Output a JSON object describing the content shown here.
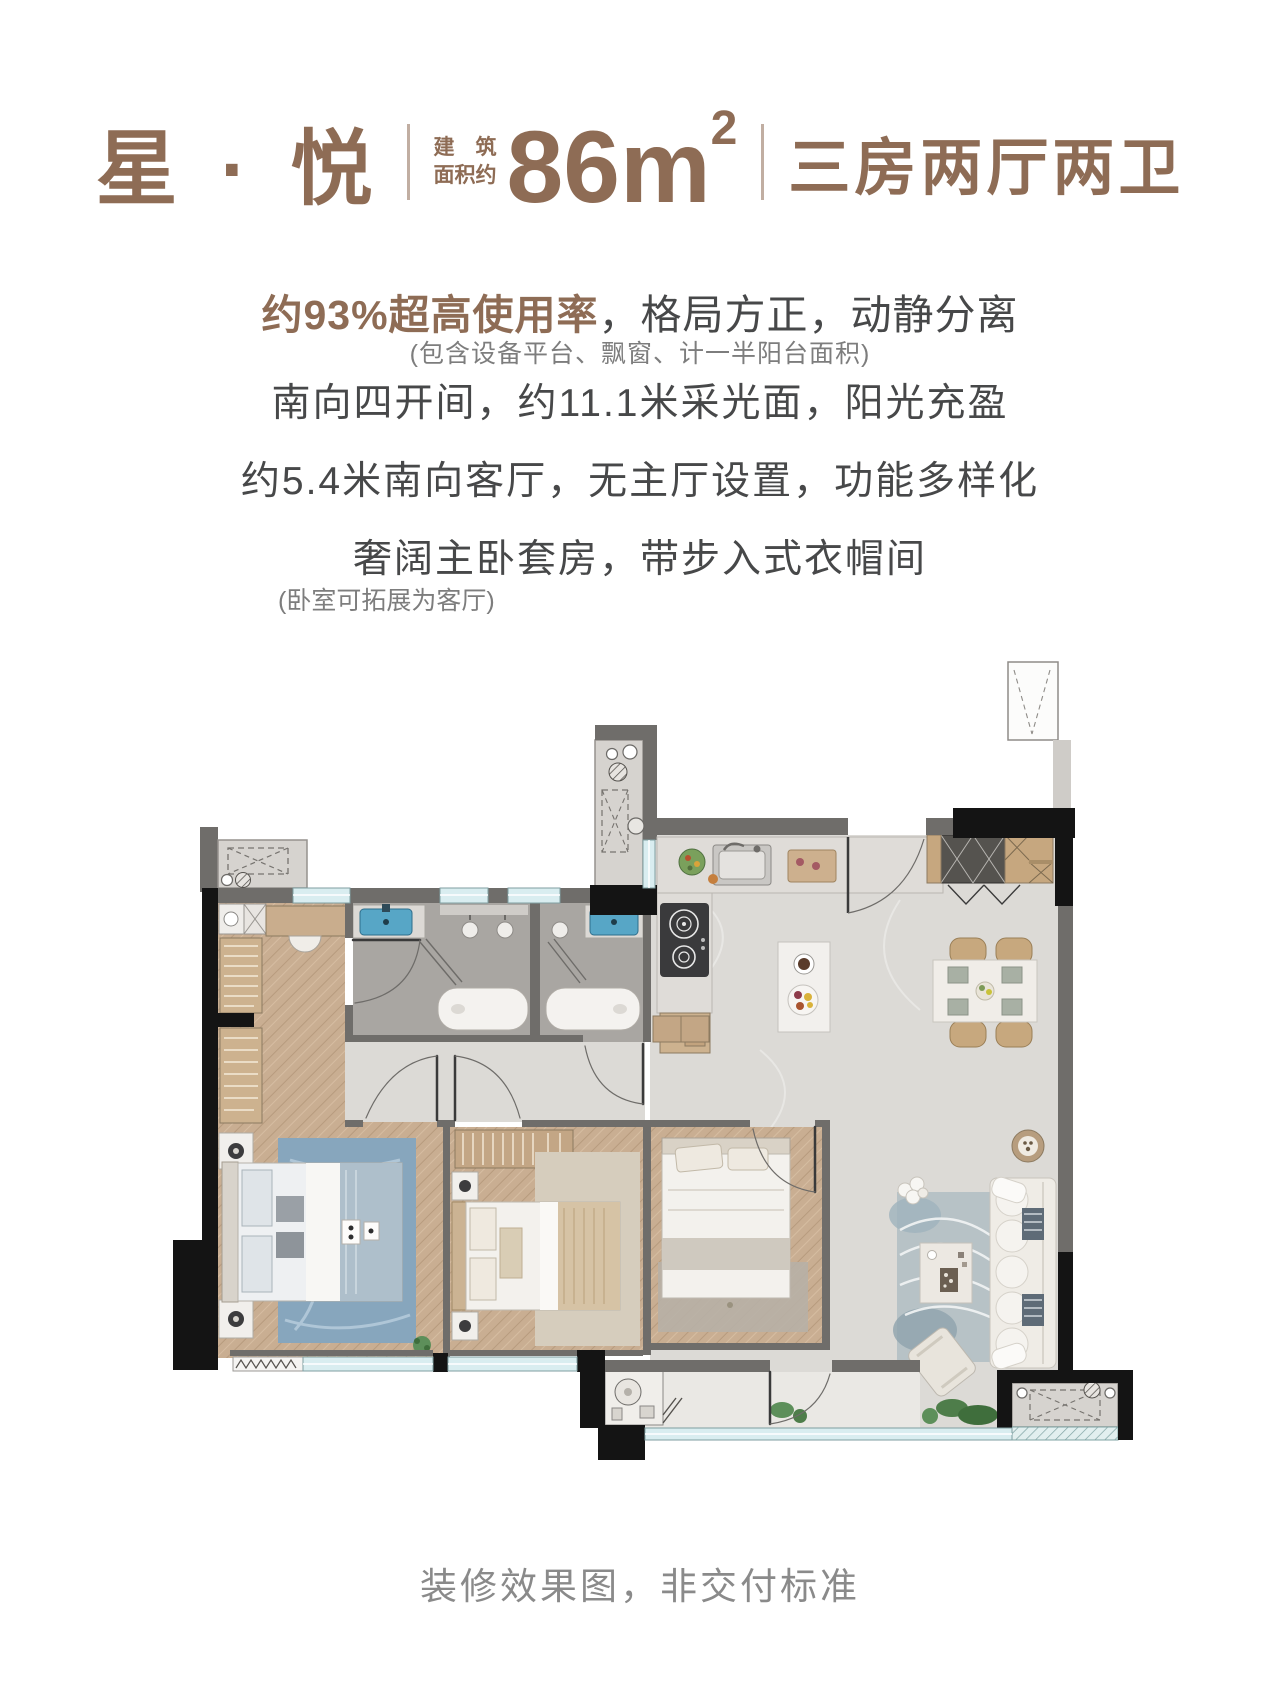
{
  "header": {
    "name": "星 · 悦",
    "area_label_line1": "建　筑",
    "area_label_line2": "面积约",
    "area_value": "86m",
    "area_sup": "2",
    "layout": "三房两厅两卫"
  },
  "features": {
    "highlight": "约93%超高使用率",
    "highlight_rest": "，格局方正，动静分离",
    "note1": "(包含设备平台、飘窗、计一半阳台面积)",
    "line2": "南向四开间，约11.1米采光面，阳光充盈",
    "line3": "约5.4米南向客厅，无主厅设置，功能多样化",
    "line4": "奢阔主卧套房，带步入式衣帽间",
    "note2": "(卧室可拓展为客厅)"
  },
  "footer": {
    "disclaimer": "装修效果图，非交付标准"
  },
  "colors": {
    "brand": "#8E6C55",
    "text_dark": "#474849",
    "text_gray": "#7D7D7D",
    "caption_gray": "#8A8A8A",
    "sink_blue": "#57A6C6",
    "window_cyan": "#D9EDF0",
    "wall_gray": "#6F6D6A",
    "wall_black": "#141414",
    "wood_floor": "#C9AE92",
    "marble_floor": "#DCDAD6"
  }
}
